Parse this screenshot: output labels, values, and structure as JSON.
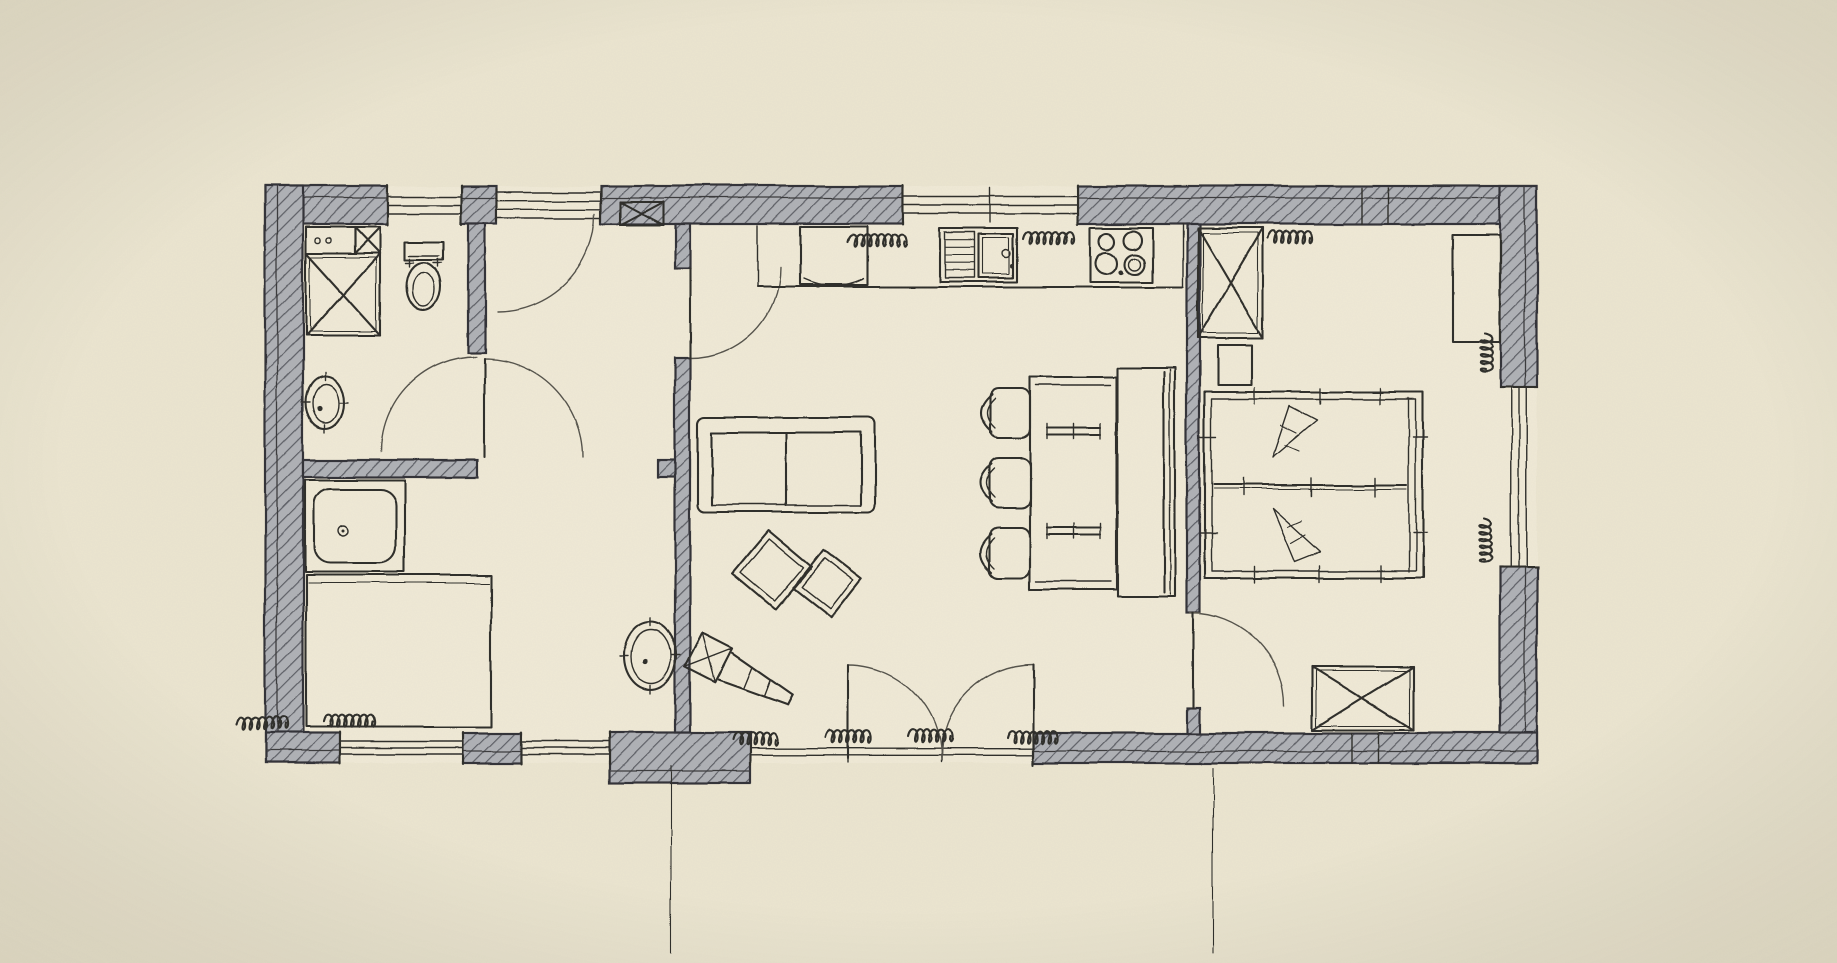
{
  "canvas": {
    "width": 1837,
    "height": 963
  },
  "colors": {
    "paper": "#ebe5d0",
    "paper_light": "#efe9d6",
    "wall_fill": "#afb1b6",
    "hatch_stroke": "#5d5f66",
    "ink": "#2e2d2a",
    "ink_soft": "#54524c",
    "vignette": "rgba(110,100,72,0.14)"
  },
  "floorplan": {
    "outline": {
      "x": 265,
      "y": 186,
      "w": 1272,
      "h": 577
    },
    "walls": [
      {
        "name": "top-wall-a",
        "x": 265,
        "y": 186,
        "w": 123,
        "h": 38,
        "side": "top"
      },
      {
        "name": "top-wall-b",
        "x": 461,
        "y": 186,
        "w": 35,
        "h": 38,
        "side": "top"
      },
      {
        "name": "top-wall-c",
        "x": 601,
        "y": 186,
        "w": 302,
        "h": 38,
        "side": "top"
      },
      {
        "name": "top-wall-d",
        "x": 1077,
        "y": 186,
        "w": 460,
        "h": 38,
        "side": "top"
      },
      {
        "name": "left-wall",
        "x": 265,
        "y": 186,
        "w": 38,
        "h": 577,
        "side": "left"
      },
      {
        "name": "right-wall-top",
        "x": 1500,
        "y": 186,
        "w": 37,
        "h": 201,
        "side": "right"
      },
      {
        "name": "right-wall-bottom",
        "x": 1500,
        "y": 568,
        "w": 37,
        "h": 195,
        "side": "right"
      },
      {
        "name": "bottom-wall-a",
        "x": 265,
        "y": 733,
        "w": 75,
        "h": 30,
        "side": "bottom"
      },
      {
        "name": "bottom-wall-b",
        "x": 463,
        "y": 733,
        "w": 58,
        "h": 30,
        "side": "bottom"
      },
      {
        "name": "bottom-wall-step",
        "x": 610,
        "y": 733,
        "w": 140,
        "h": 50,
        "side": "bottom"
      },
      {
        "name": "bottom-wall-c",
        "x": 1033,
        "y": 733,
        "w": 504,
        "h": 30,
        "side": "bottom"
      },
      {
        "name": "wall-bath-right",
        "x": 468,
        "y": 224,
        "w": 17,
        "h": 129,
        "side": "interior"
      },
      {
        "name": "wall-bath-bottom",
        "x": 303,
        "y": 460,
        "w": 174,
        "h": 17,
        "side": "interior"
      },
      {
        "name": "wall-bath-bottom-stub",
        "x": 658,
        "y": 460,
        "w": 32,
        "h": 17,
        "side": "interior"
      },
      {
        "name": "wall-hall-living-upper",
        "x": 675,
        "y": 224,
        "w": 15,
        "h": 44,
        "side": "interior"
      },
      {
        "name": "wall-hall-living-lower",
        "x": 675,
        "y": 358,
        "w": 15,
        "h": 375,
        "side": "interior"
      },
      {
        "name": "wall-living-bedroom-upper",
        "x": 1187,
        "y": 224,
        "w": 13,
        "h": 389,
        "side": "interior"
      },
      {
        "name": "wall-living-bedroom-lower",
        "x": 1187,
        "y": 707,
        "w": 13,
        "h": 26,
        "side": "interior"
      }
    ],
    "wall_joints": [
      {
        "name": "joint-top-1",
        "x1": 1362,
        "y1": 188,
        "x2": 1362,
        "y2": 224
      },
      {
        "name": "joint-top-2",
        "x1": 1388,
        "y1": 188,
        "x2": 1388,
        "y2": 224
      },
      {
        "name": "joint-bottom-1",
        "x1": 1352,
        "y1": 733,
        "x2": 1352,
        "y2": 763
      },
      {
        "name": "joint-bottom-2",
        "x1": 1378,
        "y1": 733,
        "x2": 1378,
        "y2": 763
      }
    ],
    "windows": [
      {
        "name": "window-bath-top",
        "x": 388,
        "y": 188,
        "w": 73,
        "h": 34,
        "dir": "h"
      },
      {
        "name": "entrance-glazed",
        "x": 496,
        "y": 192,
        "w": 105,
        "h": 26,
        "dir": "h",
        "boxed": true
      },
      {
        "name": "window-kitchen-top",
        "x": 903,
        "y": 188,
        "w": 174,
        "h": 34,
        "dir": "h",
        "midticks": [
          990
        ]
      },
      {
        "name": "window-right",
        "x": 1503,
        "y": 387,
        "w": 31,
        "h": 181,
        "dir": "v"
      },
      {
        "name": "window-bottom-a",
        "x": 340,
        "y": 735,
        "w": 123,
        "h": 26,
        "dir": "h"
      },
      {
        "name": "window-bottom-b",
        "x": 521,
        "y": 735,
        "w": 89,
        "h": 26,
        "dir": "h"
      },
      {
        "name": "window-bottom-terrace",
        "x": 750,
        "y": 742,
        "w": 283,
        "h": 20,
        "dir": "h",
        "midticks": [
          848,
          941,
          1033
        ]
      }
    ],
    "doors": [
      {
        "name": "door-entrance",
        "arc": "M595,214 A98,98 0 0 1 497,312"
      },
      {
        "name": "door-living",
        "arc": "M780,268 A90,90 0 0 1 690,358",
        "leaf": [
          690,
          268,
          690,
          358
        ]
      },
      {
        "name": "door-bathroom",
        "arc": "M476,357 A95,95 0 0 0 381,452"
      },
      {
        "name": "door-lower-room",
        "arc": "M484,359 A98,98 0 0 1 582,457",
        "leaf": [
          484,
          359,
          484,
          457
        ]
      },
      {
        "name": "door-bedroom",
        "arc": "M1190,613 A94,94 0 0 1 1284,707",
        "leaf": [
          1193,
          613,
          1193,
          707
        ]
      },
      {
        "name": "door-french-left",
        "arc": "M848,665 A93,93 0 0 1 941,758",
        "leaf": [
          848,
          665,
          848,
          758
        ]
      },
      {
        "name": "door-french-right",
        "arc": "M1033,665 A92,92 0 0 0 941,758",
        "leaf": [
          1033,
          665,
          1033,
          758
        ]
      }
    ],
    "furniture": [
      {
        "type": "counter-box",
        "name": "laundry-counter",
        "x": 306,
        "y": 227,
        "w": 49,
        "h": 26,
        "dots": [
          [
            318,
            240
          ],
          [
            329,
            240
          ]
        ]
      },
      {
        "type": "crossbox",
        "name": "bath-cabinet-small",
        "x": 355,
        "y": 227,
        "w": 25,
        "h": 26
      },
      {
        "type": "crossbox",
        "name": "washing-machine",
        "x": 306,
        "y": 253,
        "w": 74,
        "h": 82,
        "inset": 4
      },
      {
        "type": "toilet",
        "name": "toilet",
        "x": 405,
        "y": 242
      },
      {
        "type": "oval-sink",
        "name": "bathroom-sink",
        "cx": 325,
        "cy": 402,
        "rx": 19,
        "ry": 26
      },
      {
        "type": "shower",
        "name": "shower",
        "x": 305,
        "y": 480,
        "w": 100,
        "h": 92
      },
      {
        "type": "bed-simple",
        "name": "lower-room-furniture",
        "x": 306,
        "y": 575,
        "w": 185,
        "h": 152
      },
      {
        "type": "oval-sink",
        "name": "hall-sink",
        "cx": 650,
        "cy": 656,
        "rx": 26,
        "ry": 34
      },
      {
        "type": "lounge-chair",
        "name": "lounge-chair",
        "cx": 740,
        "cy": 674,
        "rot": 27
      },
      {
        "type": "sofa",
        "name": "sofa",
        "x": 698,
        "y": 417,
        "w": 177,
        "h": 95
      },
      {
        "type": "diamond-table",
        "name": "coffee-table-large",
        "cx": 772,
        "cy": 570,
        "size": 56,
        "rot": 40
      },
      {
        "type": "diamond-table",
        "name": "coffee-table-small",
        "cx": 827,
        "cy": 583,
        "size": 48,
        "rot": 38
      },
      {
        "type": "dining-table",
        "name": "dining-table",
        "x": 1030,
        "y": 377,
        "w": 86,
        "h": 213,
        "bars": [
          [
            1047,
            428,
            1100
          ],
          [
            1047,
            527,
            1100
          ]
        ]
      },
      {
        "type": "chair",
        "name": "dining-chair-1",
        "x": 990,
        "y": 388,
        "w": 40,
        "h": 50
      },
      {
        "type": "chair",
        "name": "dining-chair-2",
        "x": 990,
        "y": 458,
        "w": 40,
        "h": 50
      },
      {
        "type": "chair",
        "name": "dining-chair-3",
        "x": 990,
        "y": 528,
        "w": 40,
        "h": 50
      },
      {
        "type": "bench",
        "name": "wall-bench",
        "x": 1117,
        "y": 368,
        "w": 58,
        "h": 229
      },
      {
        "type": "crossbox",
        "name": "wardrobe-top",
        "x": 1198,
        "y": 228,
        "w": 65,
        "h": 110,
        "inset": 5
      },
      {
        "type": "rect",
        "name": "nightstand",
        "x": 1218,
        "y": 345,
        "w": 34,
        "h": 40
      },
      {
        "type": "bed-double",
        "name": "double-bed",
        "x": 1205,
        "y": 392,
        "w": 218,
        "h": 186
      },
      {
        "type": "crossbox",
        "name": "wardrobe-bottom",
        "x": 1312,
        "y": 667,
        "w": 101,
        "h": 63,
        "inset": 4
      },
      {
        "type": "rect",
        "name": "bedroom-desk",
        "x": 1453,
        "y": 235,
        "w": 47,
        "h": 107
      },
      {
        "type": "kitchen",
        "name": "kitchen-counter",
        "front_y": 287,
        "x1": 757,
        "x2": 1183,
        "fridge": {
          "x": 800,
          "y": 227,
          "w": 67,
          "h": 58
        },
        "sink": {
          "x": 940,
          "y": 228,
          "w": 77,
          "h": 54,
          "drain": {
            "x": 945,
            "y": 232,
            "w": 29,
            "h": 46
          },
          "basin": {
            "x": 978,
            "y": 234,
            "w": 35,
            "h": 44
          },
          "tap": [
            1006,
            254
          ]
        },
        "cooktop": {
          "x": 1090,
          "y": 228,
          "w": 63,
          "h": 54,
          "burners": [
            [
              1107,
              241,
              8
            ],
            [
              1133,
              240,
              9
            ],
            [
              1106,
              263,
              11
            ],
            [
              1135,
              264,
              10
            ]
          ],
          "knob": [
            1121,
            272
          ]
        }
      },
      {
        "type": "crossbox",
        "name": "chimney",
        "x": 620,
        "y": 202,
        "w": 43,
        "h": 23,
        "dark": true
      }
    ],
    "annotations": [
      {
        "name": "label-scribble-kitchen-1",
        "cx": 875,
        "cy": 239,
        "len": 54,
        "rot": 0
      },
      {
        "name": "label-scribble-kitchen-2",
        "cx": 1046,
        "cy": 236,
        "len": 46,
        "rot": 0
      },
      {
        "name": "label-scribble-kitchen-3",
        "cx": 1290,
        "cy": 235,
        "len": 44,
        "rot": 0
      },
      {
        "name": "label-scribble-bottom-1",
        "cx": 259,
        "cy": 721,
        "len": 46,
        "rot": 0
      },
      {
        "name": "label-scribble-bottom-2",
        "cx": 348,
        "cy": 719,
        "len": 48,
        "rot": 0
      },
      {
        "name": "label-scribble-bottom-3",
        "cx": 755,
        "cy": 737,
        "len": 44,
        "rot": 0
      },
      {
        "name": "label-scribble-bottom-4",
        "cx": 846,
        "cy": 735,
        "len": 40,
        "rot": 0
      },
      {
        "name": "label-scribble-bottom-5",
        "cx": 927,
        "cy": 734,
        "len": 40,
        "rot": 0
      },
      {
        "name": "label-scribble-bottom-6",
        "cx": 1030,
        "cy": 735,
        "len": 46,
        "rot": 0
      },
      {
        "name": "label-scribble-right-1",
        "cx": 1488,
        "cy": 352,
        "len": 36,
        "rot": 90
      },
      {
        "name": "label-scribble-right-2",
        "cx": 1488,
        "cy": 540,
        "len": 44,
        "rot": 90
      }
    ],
    "reference_lines": [
      {
        "name": "axis-line-left",
        "x1": 671,
        "y1": 766,
        "x2": 671,
        "y2": 952
      },
      {
        "name": "axis-line-right",
        "x1": 1213,
        "y1": 768,
        "x2": 1213,
        "y2": 952
      }
    ]
  }
}
